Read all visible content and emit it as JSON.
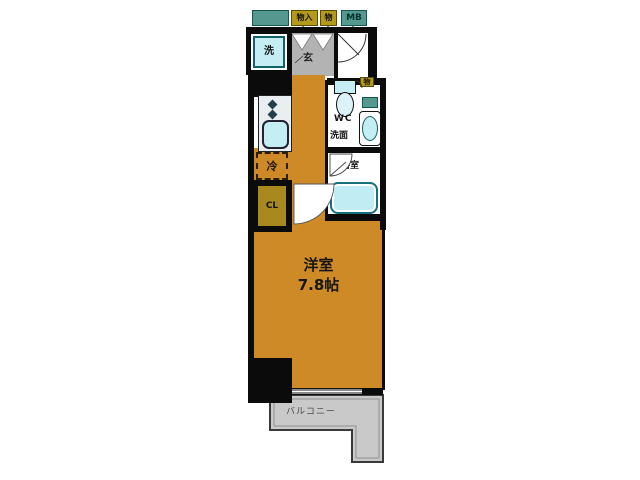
{
  "plan": {
    "callouts": {
      "storage_closet": "物入",
      "storage": "物",
      "meter_box": "MB",
      "wall_storage": "物"
    },
    "rooms": {
      "entrance": "玄",
      "laundry": "洗",
      "refrigerator": "冷",
      "closet": "CL",
      "toilet": "WC",
      "washroom": "洗面",
      "bathroom": "浴室",
      "main_room_name": "洋室",
      "main_room_size": "7.8帖",
      "balcony": "バルコニー"
    },
    "colors": {
      "room_floor": "#cf8a28",
      "entrance_floor": "#b3b3b3",
      "balcony_fill": "#c9c9c9",
      "fixture_cyan": "#c4edf4",
      "fixture_border": "#16606d",
      "label_yellow": "#b39a1a",
      "label_teal": "#55988f",
      "closet_fill": "#a8891f",
      "wall": "#0b0b0b"
    }
  }
}
